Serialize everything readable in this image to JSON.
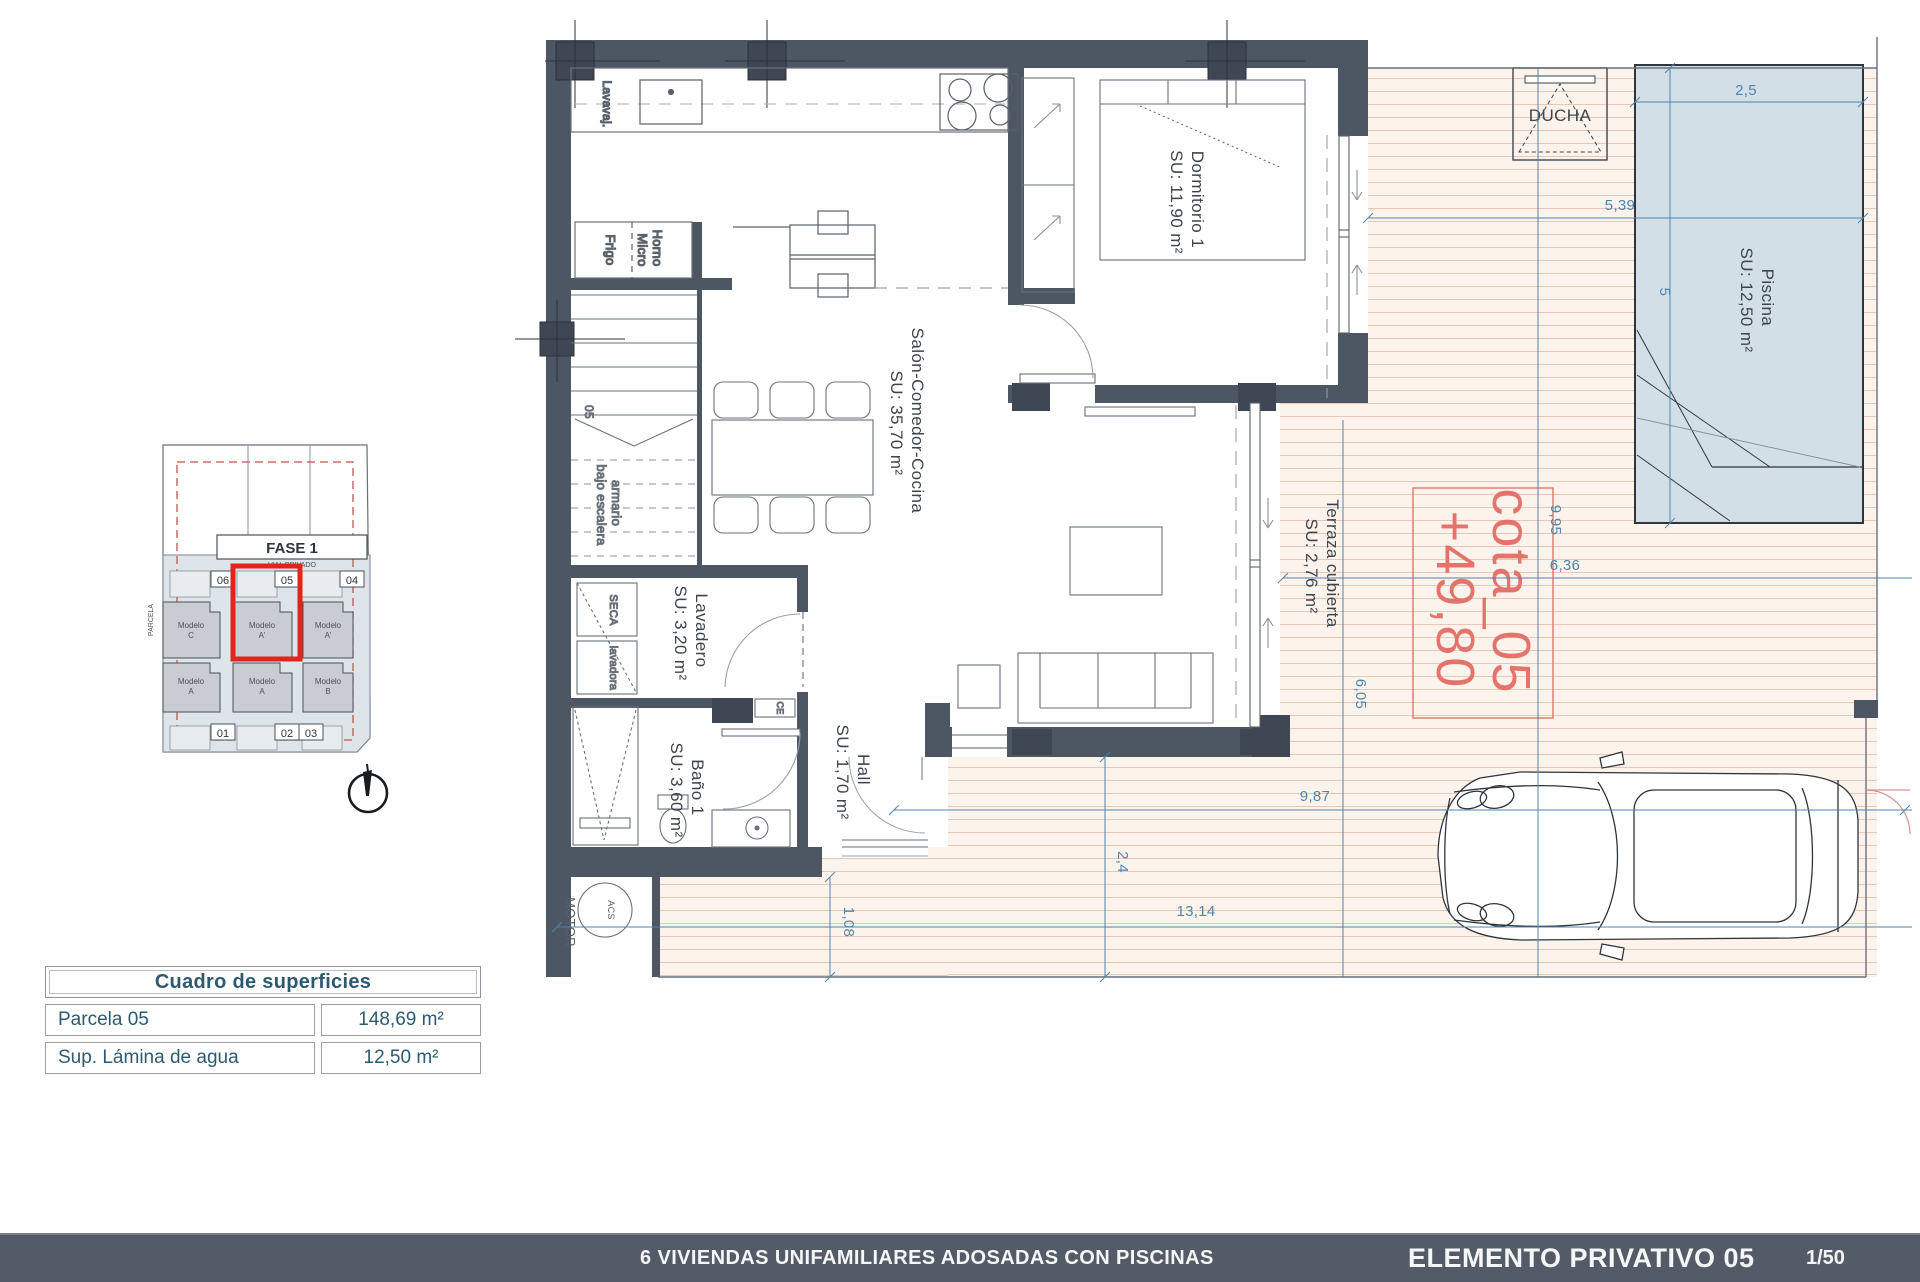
{
  "plan": {
    "rooms": {
      "dormitorio": {
        "name": "Dormitorio 1",
        "area": "SU: 11,90 m²"
      },
      "salon": {
        "name": "Salón-Comedor-Cocina",
        "area": "SU: 35,70 m²"
      },
      "lavadero": {
        "name": "Lavadero",
        "area": "SU: 3,20 m²"
      },
      "bano": {
        "name": "Baño 1",
        "area": "SU: 3,60 m²"
      },
      "hall": {
        "name": "Hall",
        "area": "SU: 1,70 m²"
      },
      "terraza": {
        "name": "Terraza cubierta",
        "area": "SU: 2,76 m²"
      },
      "piscina": {
        "name": "Piscina",
        "area": "SU: 12,50 m²"
      },
      "ducha": "DUCHA"
    },
    "fixtures": {
      "lavavajillas": "Lavavaj.",
      "frigo": "Frigo",
      "horno_line1": "Horno",
      "horno_line2": "Micro",
      "seca": "SECA",
      "lavadora": "lavadora",
      "armario_line1": "armario",
      "armario_line2": "bajo escalera",
      "stair_number": "05",
      "motor": "MOTOR",
      "acs": "ACS",
      "ce": "CE"
    },
    "cota": {
      "line1": "cota_05",
      "line2": "+49,80"
    },
    "dimensions": {
      "pool_width": "2,5",
      "pool_setback": "5,39",
      "pool_length": "5",
      "plot_depth": "9,95",
      "terrace_width": "6,36",
      "terrace_depth": "6,05",
      "drive_width": "9,87",
      "drive_depth": "2,4",
      "plot_width": "13,14",
      "side_strip": "1,08"
    }
  },
  "site_plan": {
    "fase": "FASE 1",
    "vial": "VIAL PRIVADO",
    "parcela": "PARCELA",
    "plots_top": [
      "06",
      "05",
      "04"
    ],
    "plots_bottom": [
      "01",
      "02",
      "03"
    ],
    "models": [
      {
        "line1": "Modelo",
        "line2": "C"
      },
      {
        "line1": "Modelo",
        "line2": "A'"
      },
      {
        "line1": "Modelo",
        "line2": "A'"
      },
      {
        "line1": "Modelo",
        "line2": "A"
      },
      {
        "line1": "Modelo",
        "line2": "A"
      },
      {
        "line1": "Modelo",
        "line2": "B"
      }
    ]
  },
  "surface_table": {
    "title": "Cuadro de superficies",
    "rows": [
      {
        "label": "Parcela 05",
        "value": "148,69 m²"
      },
      {
        "label": "Sup. Lámina de agua",
        "value": "12,50 m²"
      }
    ]
  },
  "footer": {
    "project": "6 VIVIENDAS UNIFAMILIARES ADOSADAS CON PISCINAS",
    "sheet": "ELEMENTO PRIVATIVO 05",
    "scale": "1/50"
  },
  "colors": {
    "wall": "#4d5663",
    "wall_dark": "#3f4754",
    "dim_blue": "#4e86ad",
    "deck_line": "#e7c7b6",
    "pool_fill": "#d3dfe7",
    "accent_red": "#e1251b",
    "cota_red": "#e4746b",
    "footer_bg": "#535b66"
  }
}
